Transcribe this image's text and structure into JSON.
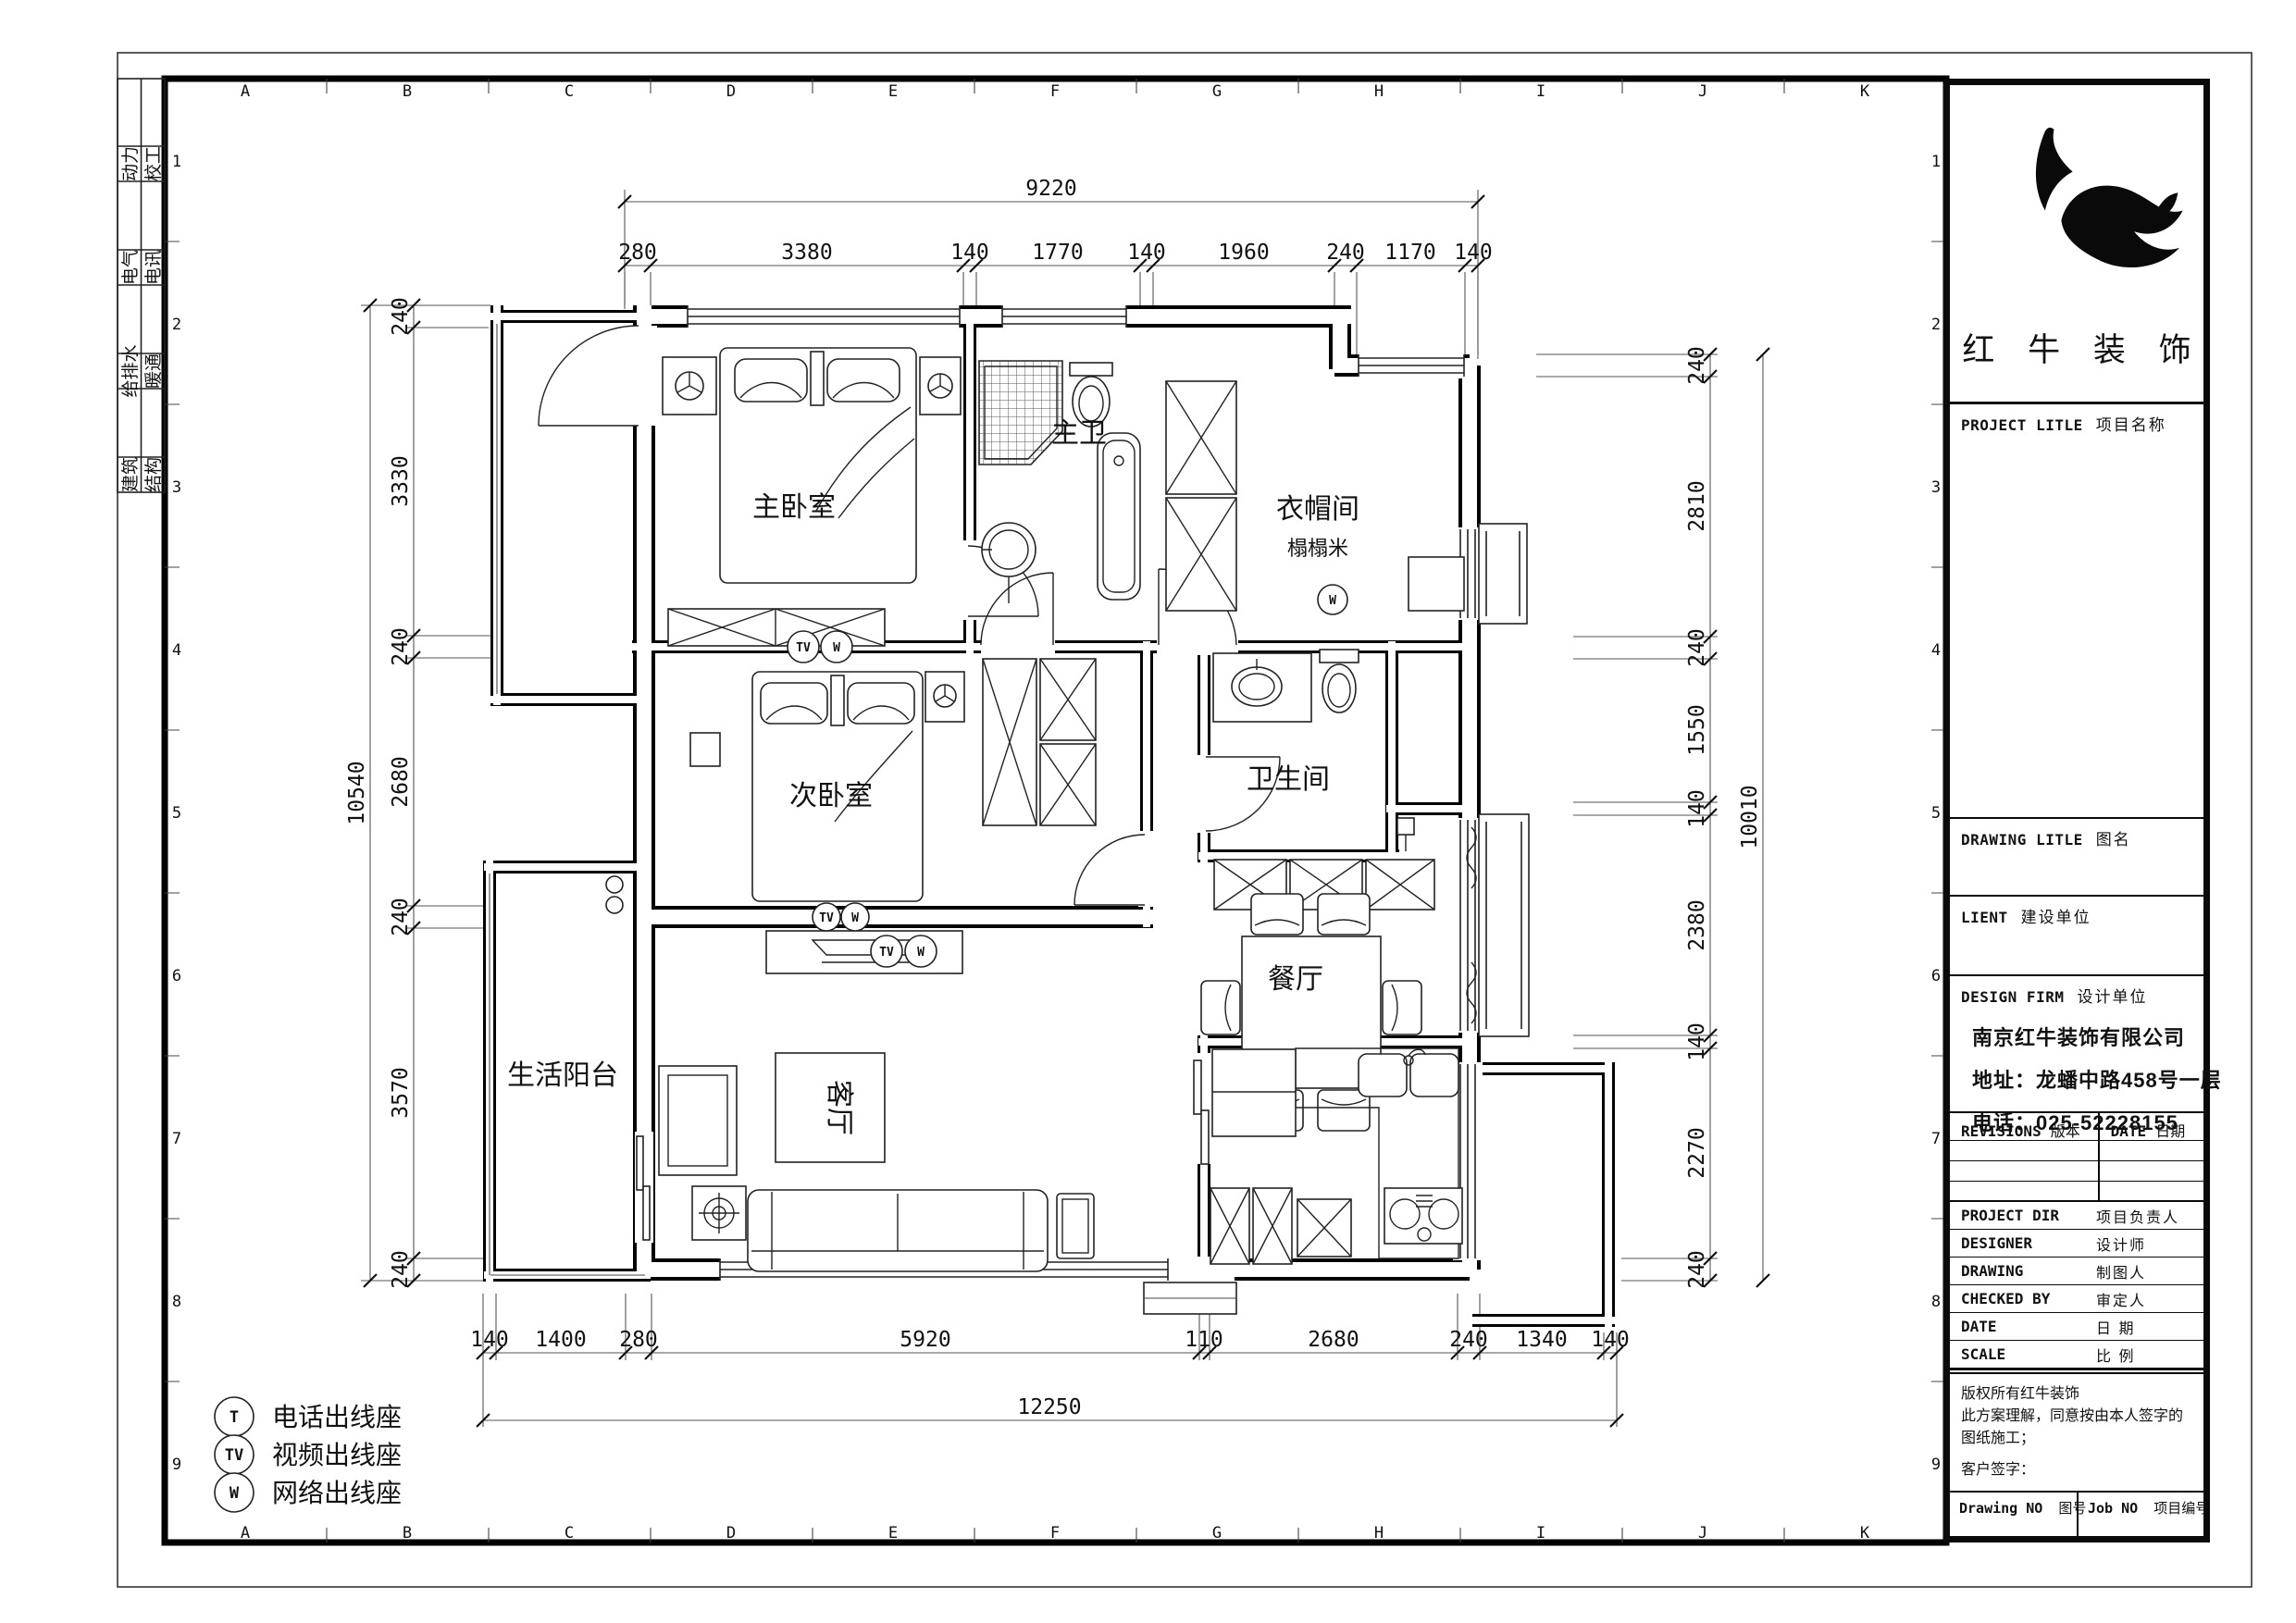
{
  "grid": {
    "letters": [
      "A",
      "B",
      "C",
      "D",
      "E",
      "F",
      "G",
      "H",
      "I",
      "J",
      "K"
    ],
    "numbers": [
      "1",
      "2",
      "3",
      "4",
      "5",
      "6",
      "7",
      "8",
      "9"
    ]
  },
  "disciplines": {
    "col1": [
      "动力",
      "电气",
      "给排水",
      "建筑"
    ],
    "col2": [
      "校工",
      "电讯",
      "暖通",
      "结构"
    ]
  },
  "legend": {
    "items": [
      {
        "symbol": "T",
        "label": "电话出线座"
      },
      {
        "symbol": "TV",
        "label": "视频出线座"
      },
      {
        "symbol": "W",
        "label": "网络出线座"
      }
    ]
  },
  "rooms": {
    "master_bedroom": "主卧室",
    "master_bath": "主卫",
    "cloakroom": "衣帽间",
    "cloakroom_sub": "榻榻米",
    "second_bedroom": "次卧室",
    "bathroom": "卫生间",
    "dining": "餐厅",
    "living": "客厅",
    "balcony": "生活阳台"
  },
  "outlets": {
    "tv": "TV",
    "w": "W"
  },
  "dims": {
    "top": {
      "overall": "9220",
      "segments": [
        "280",
        "3380",
        "140",
        "1770",
        "140",
        "1960",
        "240",
        "1170",
        "140"
      ]
    },
    "left": {
      "overall": "10540",
      "segments": [
        "240",
        "3330",
        "240",
        "2680",
        "240",
        "3570",
        "240"
      ]
    },
    "right": {
      "overall": "10010",
      "segments": [
        "240",
        "2810",
        "240",
        "1550",
        "140",
        "2380",
        "140",
        "2270",
        "240"
      ]
    },
    "bottom": {
      "overall": "12250",
      "segments": [
        "140",
        "1400",
        "280",
        "5920",
        "110",
        "2680",
        "240",
        "1340",
        "140"
      ]
    }
  },
  "title_block": {
    "company": "红 牛 装 饰",
    "project": {
      "en": "PROJECT LITLE",
      "zh": "项目名称"
    },
    "drawing_title": {
      "en": "DRAWING LITLE",
      "zh": "图名"
    },
    "client": {
      "en": "LIENT",
      "zh": "建设单位"
    },
    "design_firm": {
      "en": "DESIGN FIRM",
      "zh": "设计单位"
    },
    "firm_name": "南京红牛装饰有限公司",
    "firm_addr": "地址：龙蟠中路458号一层",
    "firm_tel": "电话：025-52228155",
    "revisions": {
      "en": "REVISIONS",
      "zh": "版本"
    },
    "date_col": {
      "en": "DATE",
      "zh": "日期"
    },
    "small_rows": [
      {
        "en": "PROJECT DIR",
        "zh": "项目负责人"
      },
      {
        "en": "DESIGNER",
        "zh": "设计师"
      },
      {
        "en": "DRAWING",
        "zh": "制图人"
      },
      {
        "en": "CHECKED BY",
        "zh": "审定人"
      },
      {
        "en": "DATE",
        "zh": "日  期"
      },
      {
        "en": "SCALE",
        "zh": "比  例"
      }
    ],
    "copyright1": "版权所有红牛装饰",
    "copyright2": "此方案理解，同意按由本人签字的图纸施工；",
    "signature": "客户签字：",
    "drawing_no": {
      "en": "Drawing NO",
      "zh": "图号"
    },
    "job_no": {
      "en": "Job NO",
      "zh": "项目编号"
    }
  }
}
